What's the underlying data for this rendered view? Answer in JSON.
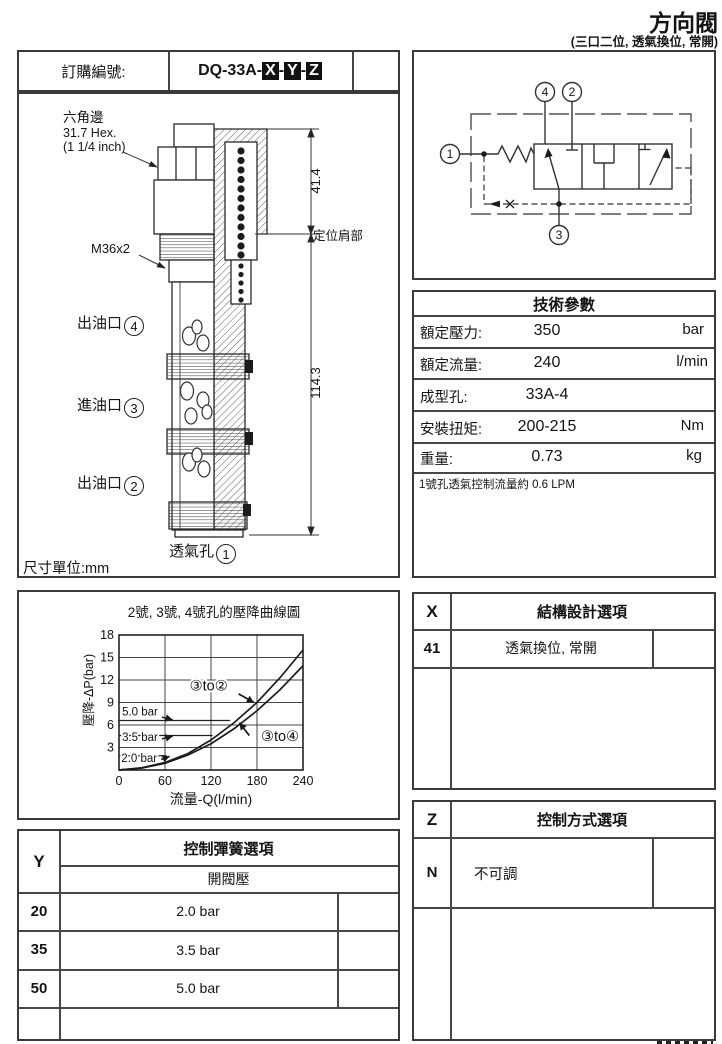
{
  "page": {
    "title": "方向閥",
    "subtitle": "(三口二位, 透氣換位, 常開)",
    "unit_note": "尺寸單位:mm"
  },
  "order": {
    "label": "訂購編號:",
    "code_prefix": "DQ-33A",
    "separator": "-",
    "boxed": [
      "X",
      "Y",
      "Z"
    ]
  },
  "drawing": {
    "hex_label_1": "六角邊",
    "hex_label_2": "31.7 Hex.",
    "hex_label_3": "(1 1/4 inch)",
    "thread_label": "M36x2",
    "port4_label": "出油口",
    "port4_num": "4",
    "port3_label": "進油口",
    "port3_num": "3",
    "port2_label": "出油口",
    "port2_num": "2",
    "vent_label": "透氣孔",
    "vent_num": "1",
    "shoulder_label": "定位肩部",
    "dim_upper": "41.4",
    "dim_total": "114.3"
  },
  "symbol": {
    "port_top_left": "4",
    "port_top_right": "2",
    "port_left": "1",
    "port_bottom": "3"
  },
  "tech": {
    "header": "技術參數",
    "rows": [
      {
        "label": "額定壓力:",
        "value": "350",
        "unit": "bar"
      },
      {
        "label": "額定流量:",
        "value": "240",
        "unit": "l/min"
      },
      {
        "label": "成型孔:",
        "value": "33A-4",
        "unit": ""
      },
      {
        "label": "安裝扭矩:",
        "value": "200-215",
        "unit": "Nm"
      },
      {
        "label": "重量:",
        "value": "0.73",
        "unit": "kg"
      }
    ],
    "note": "1號孔透氣控制流量約 0.6 LPM"
  },
  "options_x": {
    "code": "X",
    "header": "結構設計選項",
    "rows": [
      {
        "code": "41",
        "desc": "透氣換位, 常開"
      }
    ]
  },
  "options_y": {
    "code": "Y",
    "header": "控制彈簧選項",
    "subheader": "開閥壓",
    "rows": [
      {
        "code": "20",
        "desc": "2.0 bar"
      },
      {
        "code": "35",
        "desc": "3.5 bar"
      },
      {
        "code": "50",
        "desc": "5.0 bar"
      }
    ]
  },
  "options_z": {
    "code": "Z",
    "header": "控制方式選項",
    "rows": [
      {
        "code": "N",
        "desc": "不可調"
      }
    ]
  },
  "chart_data": {
    "type": "line",
    "title": "2號, 3號, 4號孔的壓降曲線圖",
    "xlabel": "流量-Q(l/min)",
    "ylabel": "壓降-ΔP(bar)",
    "xlim": [
      0,
      240
    ],
    "ylim": [
      0,
      18
    ],
    "x_ticks": [
      0,
      60,
      120,
      180,
      240
    ],
    "y_ticks": [
      3,
      6,
      9,
      12,
      15,
      18
    ],
    "grid": true,
    "legend_position": "none",
    "series": [
      {
        "name": "③to②",
        "points": [
          [
            0,
            0
          ],
          [
            30,
            0.3
          ],
          [
            60,
            1.0
          ],
          [
            90,
            2.2
          ],
          [
            120,
            4.0
          ],
          [
            150,
            6.3
          ],
          [
            180,
            9.0
          ],
          [
            210,
            12.3
          ],
          [
            240,
            16.0
          ]
        ]
      },
      {
        "name": "③to④",
        "points": [
          [
            0,
            0
          ],
          [
            30,
            0.27
          ],
          [
            60,
            0.9
          ],
          [
            90,
            2.0
          ],
          [
            120,
            3.5
          ],
          [
            150,
            5.5
          ],
          [
            180,
            7.9
          ],
          [
            210,
            10.7
          ],
          [
            240,
            13.9
          ]
        ]
      }
    ],
    "reference_lines": [
      {
        "label": "5.0 bar",
        "value_bar": 5.0,
        "drawn_at_bar": 6.6,
        "x_start": 0,
        "x_end": 145,
        "label_pos": [
          4,
          7.25
        ],
        "arrow_from": [
          56,
          7.05
        ],
        "arrow_tip": [
          70,
          6.7
        ]
      },
      {
        "label": "3.5 bar",
        "value_bar": 3.5,
        "drawn_at_bar": 4.6,
        "x_start": 0,
        "x_end": 122,
        "label_pos": [
          4,
          3.9
        ],
        "arrow_from": [
          56,
          4.15
        ],
        "arrow_tip": [
          70,
          4.5
        ]
      },
      {
        "label": "2.0 bar",
        "value_bar": 2.0,
        "drawn_at_bar": 1.9,
        "x_start": 0,
        "x_end": 62,
        "label_pos": [
          3,
          1.1
        ],
        "arrow_from": [
          55,
          1.4
        ],
        "arrow_tip": [
          66,
          1.83
        ]
      }
    ],
    "annotations": [
      {
        "label": "③to②",
        "pos": [
          117,
          10.6
        ],
        "arrow_from": [
          156,
          10.15
        ],
        "arrow_tip": [
          176,
          9.0
        ]
      },
      {
        "label": "③to④",
        "pos": [
          210,
          3.9
        ],
        "arrow_from": [
          170,
          4.6
        ],
        "arrow_tip": [
          157,
          6.3
        ]
      }
    ]
  }
}
